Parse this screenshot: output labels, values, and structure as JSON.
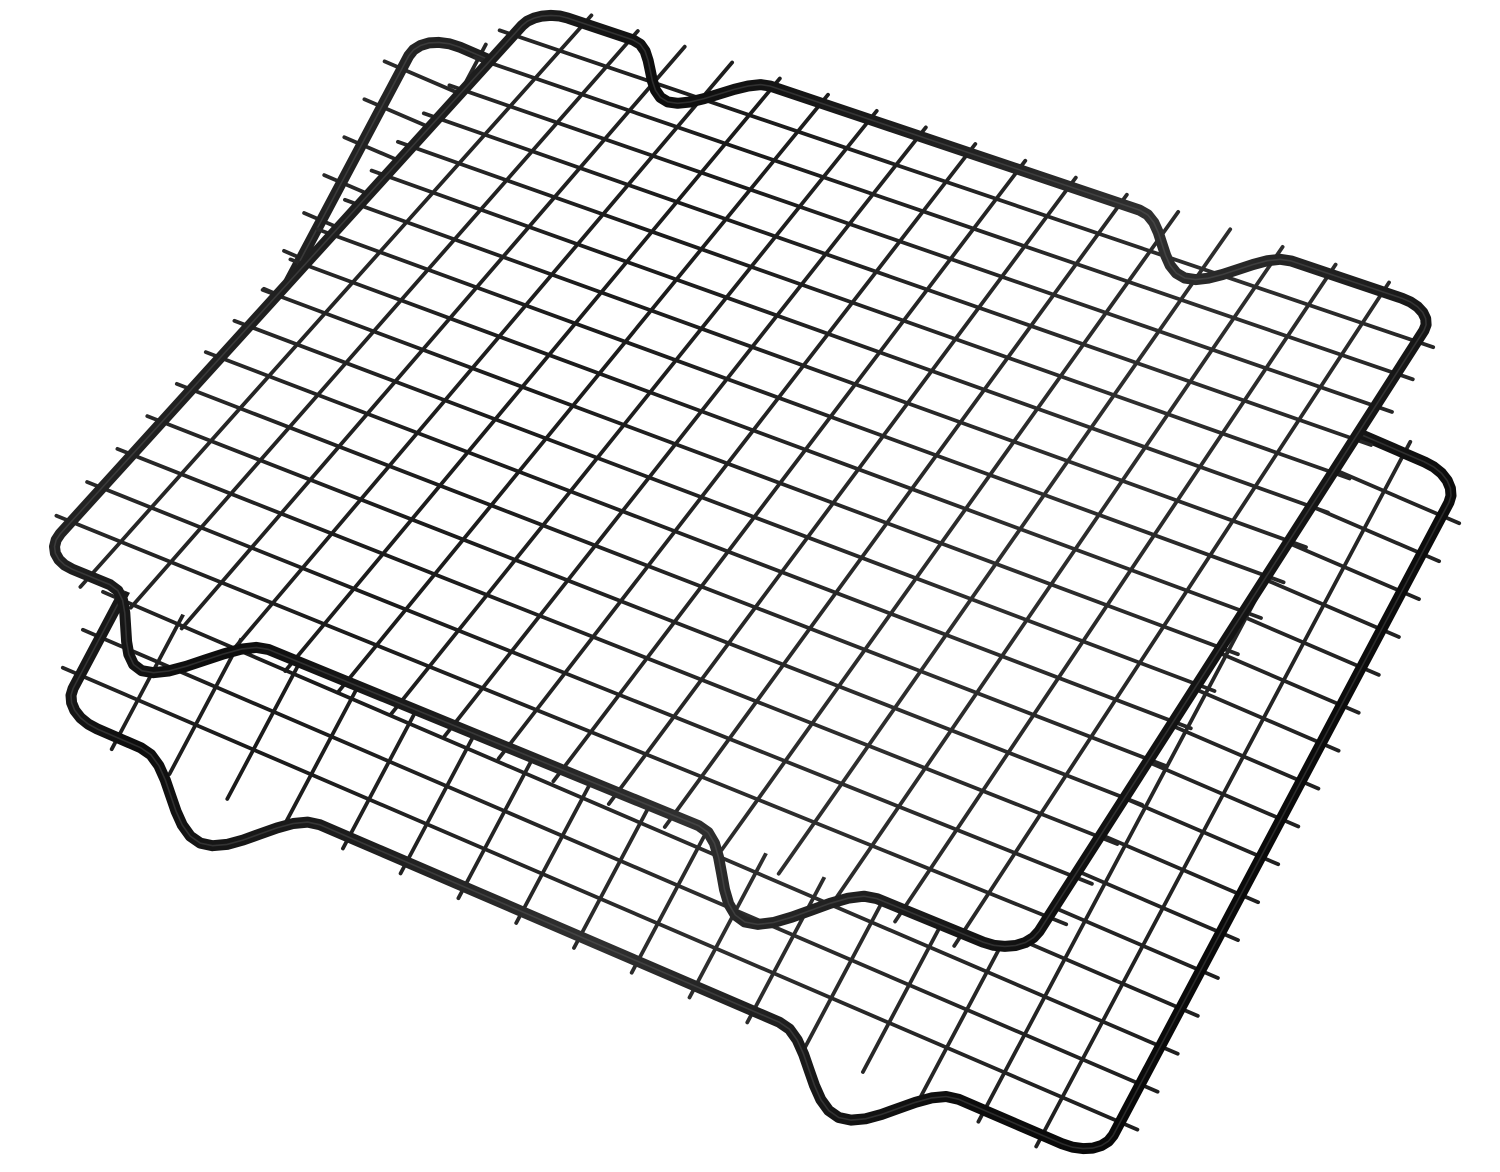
{
  "page": {
    "background_color": "#ffffff"
  },
  "product_photo": {
    "alt_text": "Two black non-stick metal wire cooling racks stacked diagonally on a white background",
    "item_count": 2,
    "colors": {
      "background": "#ffffff",
      "wire_dark": "#1b1b1b",
      "wire_mid": "#2e2e2e",
      "frame_dark": "#0d0d0d",
      "frame_highlight": "#4a4a4a",
      "sheen": "#6a6a6a"
    },
    "racks": [
      {
        "name": "bottom-rack",
        "grid_cells": 18,
        "feet_count": 4,
        "corners": {
          "top_left": [
            422,
            31
          ],
          "top_right": [
            1462,
            478
          ],
          "bottom_right": [
            1100,
            1160
          ],
          "bottom_left": [
            60,
            713
          ]
        },
        "occludes_below": false
      },
      {
        "name": "top-rack",
        "grid_cells": 18,
        "feet_count": 4,
        "corners": {
          "top_left": [
            538,
            8
          ],
          "top_right": [
            1437,
            310
          ],
          "bottom_right": [
            1022,
            958
          ],
          "bottom_left": [
            40,
            556
          ]
        },
        "occludes_below": true
      }
    ],
    "geometry": {
      "side": 720,
      "cell": 40,
      "corner_radius": 26,
      "far_feet_centers": [
        140,
        553
      ],
      "far_foot_half_width": 58,
      "far_foot_depth": 56,
      "near_feet_centers": [
        118,
        560
      ],
      "near_foot_half_width": 62,
      "near_foot_depth": 60,
      "wire_overshoot": 12,
      "frame_stroke_px": 11,
      "wire_stroke_px": 3.8
    },
    "canvas": {
      "width": 1500,
      "height": 1172
    }
  }
}
